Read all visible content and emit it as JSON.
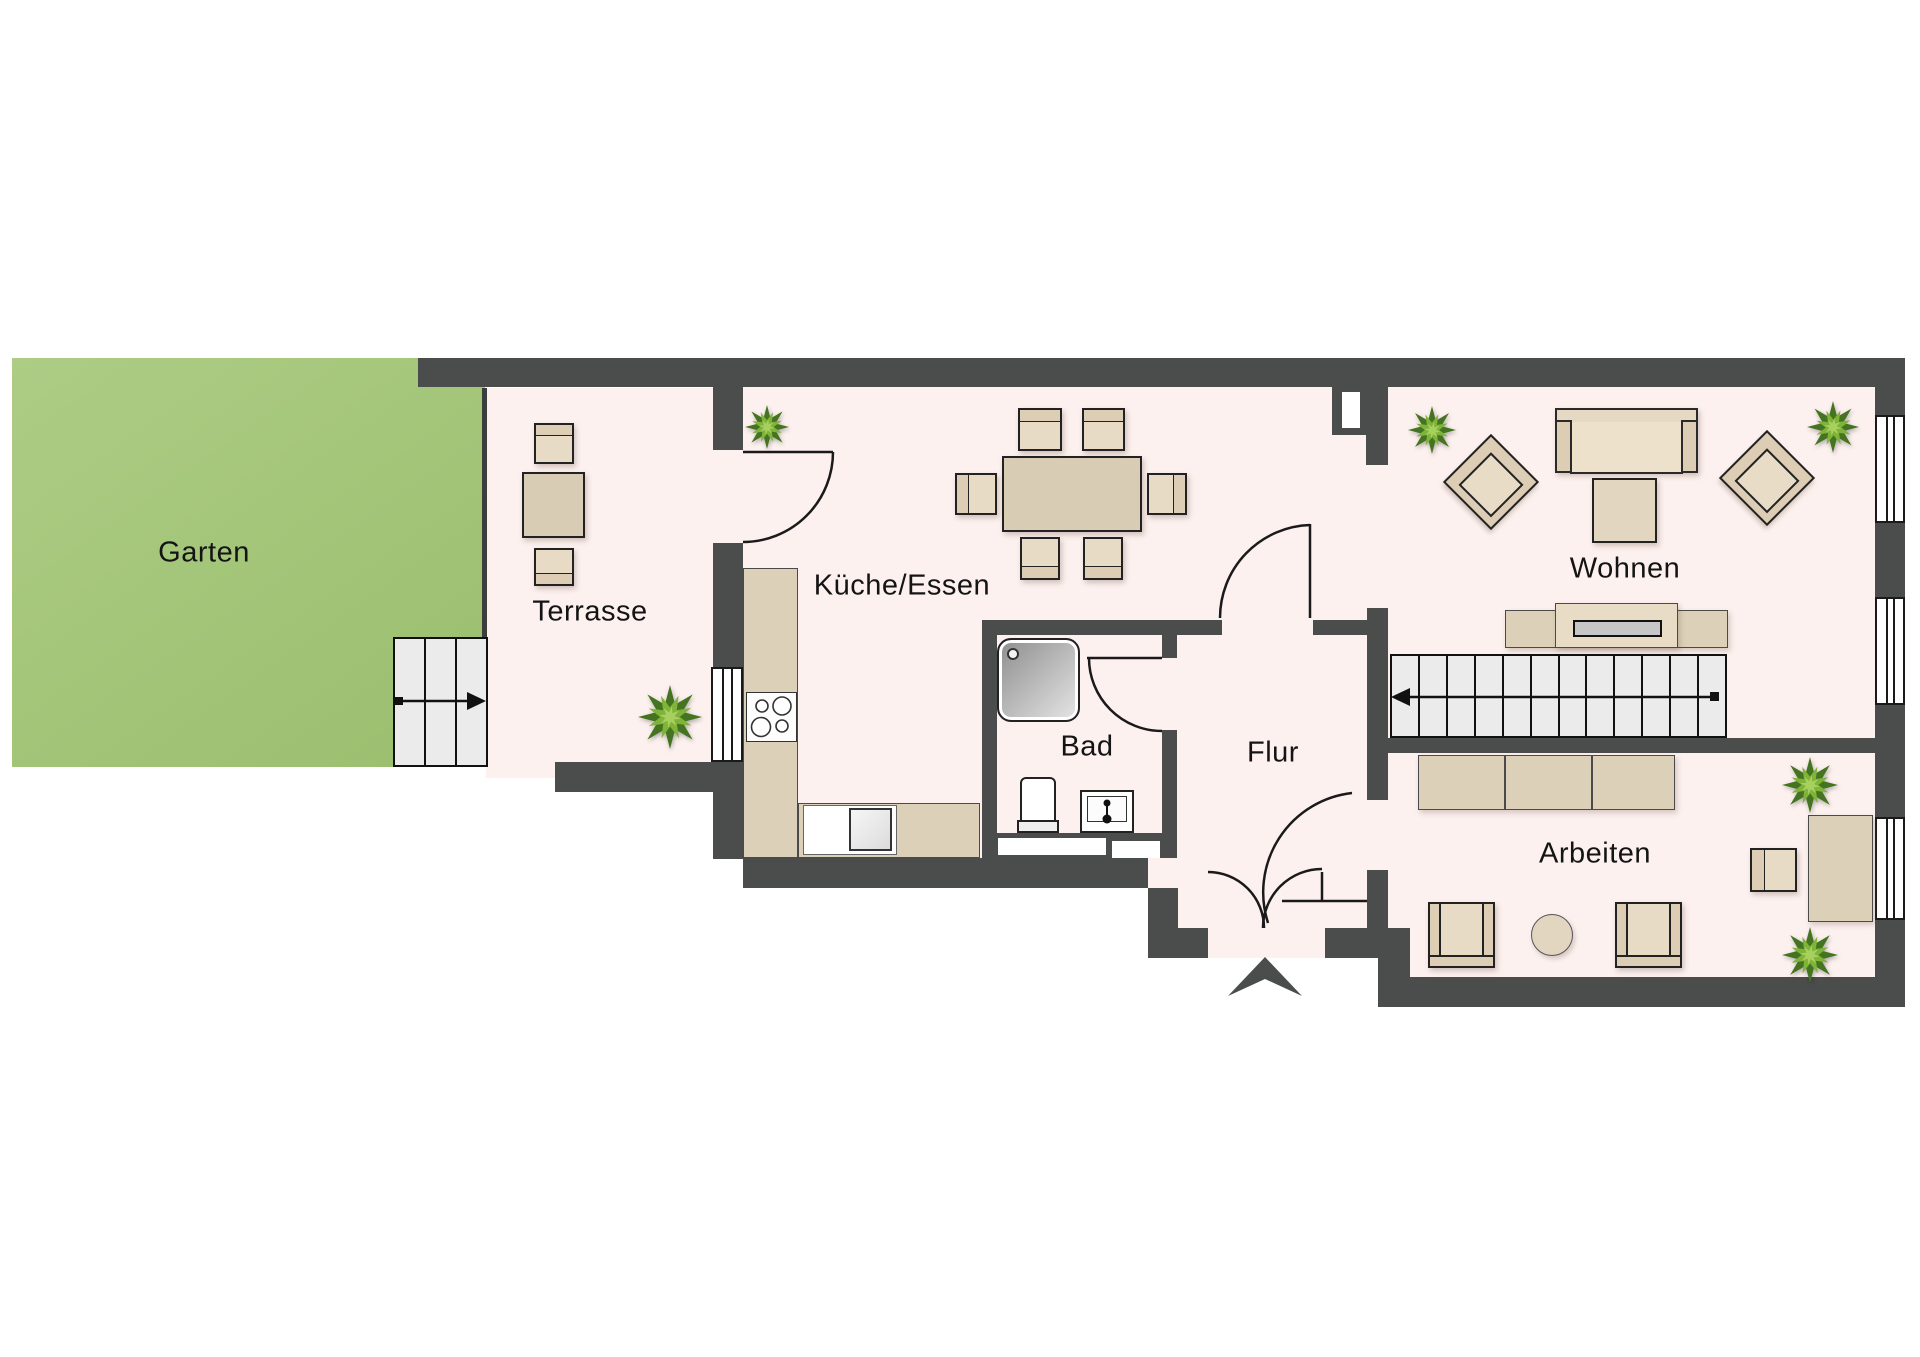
{
  "title": "Grundriss Erdgeschoss",
  "labels": {
    "garten": "Garten",
    "terrasse": "Terrasse",
    "kueche_essen": "Küche/Essen",
    "bad": "Bad",
    "flur": "Flur",
    "wohnen": "Wohnen",
    "arbeiten": "Arbeiten"
  },
  "colors": {
    "wall": "#4b4d4c",
    "floor": "#fcf1ef",
    "garden": "#a5c77b",
    "furniture_light": "#e8dbc5",
    "furniture_mid": "#ddd0b8",
    "furniture_dark": "#d9ccb4",
    "stair_tread": "#ebebeb",
    "tv_screen": "#c6c6c6",
    "plant_dark": "#44741f",
    "plant_mid": "#7fb33a",
    "plant_light": "#a8d05e",
    "label_text": "#141414"
  },
  "stairs": {
    "interior_treads": 12,
    "exterior_treads": 3,
    "interior_arrow_direction": "left",
    "exterior_arrow_direction": "right"
  },
  "icons": {
    "entrance_marker": "entrance-arrow",
    "plants": 6
  }
}
